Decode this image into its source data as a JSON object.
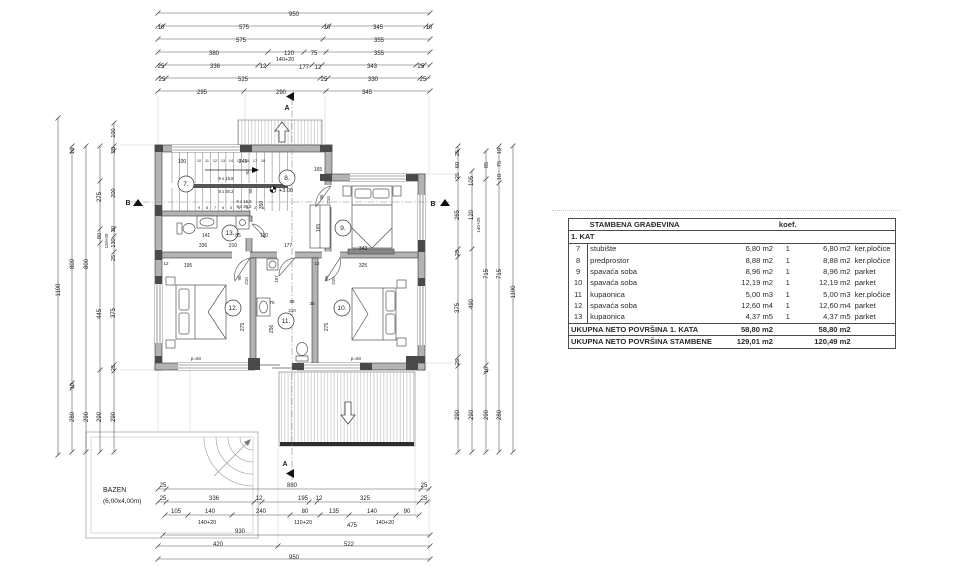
{
  "table": {
    "title": "STAMBENA GRAĐEVINA",
    "koef_label": "koef.",
    "section": "1. KAT",
    "rows": [
      {
        "num": "7",
        "name": "stubište",
        "area": "6,80 m2",
        "koef": "1",
        "area2": "6,80 m2",
        "floor": "ker.pločice"
      },
      {
        "num": "8",
        "name": "predprostor",
        "area": "8,88 m2",
        "koef": "1",
        "area2": "8,88 m2",
        "floor": "ker.pločice"
      },
      {
        "num": "9",
        "name": "spavaća soba",
        "area": "8,96 m2",
        "koef": "1",
        "area2": "8,96 m2",
        "floor": "parket"
      },
      {
        "num": "10",
        "name": "spavaća soba",
        "area": "12,19 m2",
        "koef": "1",
        "area2": "12,19 m2",
        "floor": "parket"
      },
      {
        "num": "11",
        "name": "kupaonica",
        "area": "5,00 m3",
        "koef": "1",
        "area2": "5,00 m3",
        "floor": "ker.pločice"
      },
      {
        "num": "12",
        "name": "spavaća soba",
        "area": "12,60 m4",
        "koef": "1",
        "area2": "12,60 m4",
        "floor": "parket"
      },
      {
        "num": "13",
        "name": "kupaonica",
        "area": "4,37 m5",
        "koef": "1",
        "area2": "4,37 m5",
        "floor": "parket"
      }
    ],
    "total1_label": "UKUPNA NETO POVRŠINA 1. KATA",
    "total1_a": "58,80 m2",
    "total1_b": "58,80 m2",
    "total2_label": "UKUPNA NETO POVRŠINA STAMBENE",
    "total2_a": "129,01 m2",
    "total2_b": "120,49 m2"
  },
  "pool": {
    "label1": "BAZEN",
    "label2": "(6,00x4,00m)"
  },
  "plan_texts": [
    {
      "t": "950",
      "x": 294,
      "y": 16
    },
    {
      "t": "10",
      "x": 161,
      "y": 29
    },
    {
      "t": "575",
      "x": 244,
      "y": 29
    },
    {
      "t": "10",
      "x": 327,
      "y": 29
    },
    {
      "t": "345",
      "x": 378,
      "y": 29
    },
    {
      "t": "10",
      "x": 429,
      "y": 29
    },
    {
      "t": "575",
      "x": 241,
      "y": 42
    },
    {
      "t": "355",
      "x": 379,
      "y": 42
    },
    {
      "t": "380",
      "x": 214,
      "y": 55
    },
    {
      "t": "120",
      "x": 289,
      "y": 55
    },
    {
      "t": "75",
      "x": 314,
      "y": 55
    },
    {
      "t": "355",
      "x": 379,
      "y": 55
    },
    {
      "t": "25",
      "x": 161,
      "y": 68
    },
    {
      "t": "336",
      "x": 215,
      "y": 68
    },
    {
      "t": "12",
      "x": 263,
      "y": 68
    },
    {
      "t": "140+20",
      "x": 285,
      "y": 61,
      "s": 5.5
    },
    {
      "t": "177",
      "x": 304,
      "y": 69
    },
    {
      "t": "12",
      "x": 318,
      "y": 69
    },
    {
      "t": "343",
      "x": 372,
      "y": 68
    },
    {
      "t": "25",
      "x": 421,
      "y": 68
    },
    {
      "t": "25",
      "x": 162,
      "y": 81
    },
    {
      "t": "525",
      "x": 243,
      "y": 81
    },
    {
      "t": "25",
      "x": 324,
      "y": 81
    },
    {
      "t": "330",
      "x": 373,
      "y": 81
    },
    {
      "t": "25",
      "x": 423,
      "y": 81
    },
    {
      "t": "295",
      "x": 202,
      "y": 94
    },
    {
      "t": "290",
      "x": 281,
      "y": 94
    },
    {
      "t": "345",
      "x": 367,
      "y": 94
    },
    {
      "t": "A",
      "x": 287,
      "y": 110,
      "s": 7,
      "b": 1
    },
    {
      "t": "25",
      "x": 163,
      "y": 487
    },
    {
      "t": "880",
      "x": 292,
      "y": 487
    },
    {
      "t": "25",
      "x": 424,
      "y": 487
    },
    {
      "t": "25",
      "x": 163,
      "y": 500
    },
    {
      "t": "336",
      "x": 214,
      "y": 500
    },
    {
      "t": "12",
      "x": 259,
      "y": 500
    },
    {
      "t": "195",
      "x": 303,
      "y": 500
    },
    {
      "t": "12",
      "x": 319,
      "y": 500
    },
    {
      "t": "325",
      "x": 365,
      "y": 500
    },
    {
      "t": "25",
      "x": 424,
      "y": 500
    },
    {
      "t": "105",
      "x": 176,
      "y": 513
    },
    {
      "t": "140",
      "x": 210,
      "y": 513
    },
    {
      "t": "240",
      "x": 261,
      "y": 513
    },
    {
      "t": "80",
      "x": 305,
      "y": 513
    },
    {
      "t": "135",
      "x": 334,
      "y": 513
    },
    {
      "t": "140",
      "x": 372,
      "y": 513
    },
    {
      "t": "90",
      "x": 407,
      "y": 513
    },
    {
      "t": "140+20",
      "x": 207,
      "y": 524,
      "s": 5.5
    },
    {
      "t": "110+20",
      "x": 303,
      "y": 524,
      "s": 5.5
    },
    {
      "t": "475",
      "x": 352,
      "y": 527
    },
    {
      "t": "140+20",
      "x": 385,
      "y": 524,
      "s": 5.5
    },
    {
      "t": "930",
      "x": 240,
      "y": 533
    },
    {
      "t": "420",
      "x": 218,
      "y": 546
    },
    {
      "t": "522",
      "x": 349,
      "y": 546
    },
    {
      "t": "950",
      "x": 294,
      "y": 559
    },
    {
      "t": "A",
      "x": 285,
      "y": 466,
      "s": 7,
      "b": 1
    },
    {
      "t": "1100",
      "x": 60,
      "y": 290,
      "r": 1
    },
    {
      "t": "10",
      "x": 74,
      "y": 151,
      "r": 1,
      "s": 5.5
    },
    {
      "t": "800",
      "x": 74,
      "y": 264,
      "r": 1
    },
    {
      "t": "10",
      "x": 74,
      "y": 386,
      "r": 1,
      "s": 5.5
    },
    {
      "t": "280",
      "x": 74,
      "y": 417,
      "r": 1
    },
    {
      "t": "800",
      "x": 88,
      "y": 264,
      "r": 1
    },
    {
      "t": "290",
      "x": 88,
      "y": 417,
      "r": 1
    },
    {
      "t": "275",
      "x": 101,
      "y": 197,
      "r": 1
    },
    {
      "t": "80",
      "x": 101,
      "y": 236,
      "r": 1,
      "s": 5.5
    },
    {
      "t": "445",
      "x": 101,
      "y": 314,
      "r": 1
    },
    {
      "t": "290",
      "x": 101,
      "y": 417,
      "r": 1
    },
    {
      "t": "110+20",
      "x": 108,
      "y": 241,
      "r": 1,
      "s": 4.5
    },
    {
      "t": "100",
      "x": 115,
      "y": 133,
      "r": 1,
      "s": 5.5
    },
    {
      "t": "25",
      "x": 115,
      "y": 150,
      "r": 1,
      "s": 5.5
    },
    {
      "t": "200",
      "x": 115,
      "y": 193,
      "r": 1,
      "s": 5.5
    },
    {
      "t": "20",
      "x": 115,
      "y": 229,
      "r": 1,
      "s": 5.5
    },
    {
      "t": "130",
      "x": 115,
      "y": 243,
      "r": 1,
      "s": 5.5
    },
    {
      "t": "25",
      "x": 115,
      "y": 258,
      "r": 1,
      "s": 5.5
    },
    {
      "t": "375",
      "x": 115,
      "y": 313,
      "r": 1
    },
    {
      "t": "25",
      "x": 115,
      "y": 368,
      "r": 1,
      "s": 5.5
    },
    {
      "t": "290",
      "x": 115,
      "y": 417,
      "r": 1
    },
    {
      "t": "B",
      "x": 128,
      "y": 205,
      "s": 7,
      "b": 1
    },
    {
      "t": "25",
      "x": 459,
      "y": 153,
      "r": 1,
      "s": 5.5
    },
    {
      "t": "60",
      "x": 459,
      "y": 165,
      "r": 1,
      "s": 5.5
    },
    {
      "t": "25",
      "x": 459,
      "y": 176,
      "r": 1,
      "s": 5.5
    },
    {
      "t": "265",
      "x": 459,
      "y": 215,
      "r": 1
    },
    {
      "t": "25",
      "x": 459,
      "y": 253,
      "r": 1,
      "s": 5.5
    },
    {
      "t": "375",
      "x": 459,
      "y": 308,
      "r": 1
    },
    {
      "t": "25",
      "x": 459,
      "y": 362,
      "r": 1,
      "s": 5.5
    },
    {
      "t": "290",
      "x": 459,
      "y": 415,
      "r": 1
    },
    {
      "t": "105",
      "x": 473,
      "y": 181,
      "r": 1
    },
    {
      "t": "120",
      "x": 473,
      "y": 215,
      "r": 1
    },
    {
      "t": "490",
      "x": 473,
      "y": 304,
      "r": 1
    },
    {
      "t": "290",
      "x": 473,
      "y": 415,
      "r": 1
    },
    {
      "t": "140+20",
      "x": 480,
      "y": 225,
      "r": 1,
      "s": 4.5
    },
    {
      "t": "85",
      "x": 488,
      "y": 165,
      "r": 1,
      "s": 5.5
    },
    {
      "t": "715",
      "x": 488,
      "y": 274,
      "r": 1
    },
    {
      "t": "10",
      "x": 488,
      "y": 370,
      "r": 1,
      "s": 5.5
    },
    {
      "t": "290",
      "x": 488,
      "y": 415,
      "r": 1
    },
    {
      "t": "10",
      "x": 501,
      "y": 151,
      "r": 1,
      "s": 5.5
    },
    {
      "t": "75",
      "x": 501,
      "y": 164,
      "r": 1,
      "s": 5.5
    },
    {
      "t": "10",
      "x": 501,
      "y": 177,
      "r": 1,
      "s": 5.5
    },
    {
      "t": "715",
      "x": 501,
      "y": 274,
      "r": 1
    },
    {
      "t": "280",
      "x": 501,
      "y": 415,
      "r": 1
    },
    {
      "t": "1100",
      "x": 515,
      "y": 292,
      "r": 1
    },
    {
      "t": "B",
      "x": 433,
      "y": 206,
      "s": 7,
      "b": 1
    },
    {
      "t": "100",
      "x": 182,
      "y": 163,
      "s": 5
    },
    {
      "t": "245",
      "x": 243,
      "y": 163,
      "s": 5
    },
    {
      "t": "92",
      "x": 249,
      "y": 172,
      "r": 1,
      "s": 4.5
    },
    {
      "t": "9 x 16,8",
      "x": 226,
      "y": 180,
      "s": 4.2
    },
    {
      "t": "8 x 30,2",
      "x": 226,
      "y": 193,
      "s": 4.2
    },
    {
      "t": "9 x 16,8",
      "x": 244,
      "y": 203,
      "s": 4.2
    },
    {
      "t": "8 x 30,2",
      "x": 244,
      "y": 208,
      "s": 4.2
    },
    {
      "t": "10",
      "x": 199,
      "y": 162,
      "s": 3.8
    },
    {
      "t": "11",
      "x": 207,
      "y": 162,
      "s": 3.8
    },
    {
      "t": "12",
      "x": 215,
      "y": 162,
      "s": 3.8
    },
    {
      "t": "13",
      "x": 223,
      "y": 162,
      "s": 3.8
    },
    {
      "t": "14",
      "x": 231,
      "y": 162,
      "s": 3.8
    },
    {
      "t": "15",
      "x": 239,
      "y": 162,
      "s": 3.8
    },
    {
      "t": "16",
      "x": 247,
      "y": 162,
      "s": 3.8
    },
    {
      "t": "17",
      "x": 255,
      "y": 162,
      "s": 3.8
    },
    {
      "t": "18",
      "x": 263,
      "y": 162,
      "s": 3.8
    },
    {
      "t": "9",
      "x": 199,
      "y": 209,
      "s": 3.8
    },
    {
      "t": "8",
      "x": 207,
      "y": 209,
      "s": 3.8
    },
    {
      "t": "7",
      "x": 215,
      "y": 209,
      "s": 3.8
    },
    {
      "t": "6",
      "x": 223,
      "y": 209,
      "s": 3.8
    },
    {
      "t": "5",
      "x": 231,
      "y": 209,
      "s": 3.8
    },
    {
      "t": "4",
      "x": 239,
      "y": 209,
      "s": 3.8
    },
    {
      "t": "3",
      "x": 247,
      "y": 209,
      "s": 3.8
    },
    {
      "t": "2",
      "x": 255,
      "y": 209,
      "s": 3.8
    },
    {
      "t": "1",
      "x": 263,
      "y": 209,
      "s": 3.8
    },
    {
      "t": "165",
      "x": 318,
      "y": 171,
      "s": 5
    },
    {
      "t": "+3.00",
      "x": 286,
      "y": 192,
      "s": 5.5
    },
    {
      "t": "95",
      "x": 252,
      "y": 191,
      "r": 1,
      "s": 4.5
    },
    {
      "t": "350",
      "x": 263,
      "y": 205,
      "r": 1,
      "s": 5
    },
    {
      "t": "141",
      "x": 206,
      "y": 237,
      "s": 5
    },
    {
      "t": "85",
      "x": 238,
      "y": 237,
      "s": 5
    },
    {
      "t": "110",
      "x": 264,
      "y": 237,
      "s": 5
    },
    {
      "t": "336",
      "x": 203,
      "y": 247,
      "s": 5
    },
    {
      "t": "210",
      "x": 233,
      "y": 247,
      "s": 5
    },
    {
      "t": "177",
      "x": 288,
      "y": 247,
      "s": 5
    },
    {
      "t": "12",
      "x": 166,
      "y": 265,
      "s": 4.5
    },
    {
      "t": "195",
      "x": 188,
      "y": 267,
      "s": 5
    },
    {
      "t": "12",
      "x": 317,
      "y": 265,
      "s": 4.5
    },
    {
      "t": "325",
      "x": 363,
      "y": 267,
      "s": 5
    },
    {
      "t": "107",
      "x": 278,
      "y": 279,
      "r": 1,
      "s": 4.5
    },
    {
      "t": "95",
      "x": 323,
      "y": 197,
      "r": 1,
      "s": 4.5
    },
    {
      "t": "210",
      "x": 330,
      "y": 200,
      "r": 1,
      "s": 4.5
    },
    {
      "t": "165",
      "x": 320,
      "y": 228,
      "r": 1,
      "s": 5
    },
    {
      "t": "343",
      "x": 363,
      "y": 250,
      "s": 5
    },
    {
      "t": "95",
      "x": 241,
      "y": 278,
      "r": 1,
      "s": 4.5
    },
    {
      "t": "210",
      "x": 248,
      "y": 281,
      "r": 1,
      "s": 4.5
    },
    {
      "t": "275",
      "x": 244,
      "y": 327,
      "r": 1,
      "s": 5
    },
    {
      "t": "p=60",
      "x": 196,
      "y": 360,
      "s": 4.5
    },
    {
      "t": "75",
      "x": 272,
      "y": 304,
      "s": 4.5
    },
    {
      "t": "85",
      "x": 292,
      "y": 303,
      "s": 4.5
    },
    {
      "t": "210",
      "x": 292,
      "y": 312,
      "s": 4.5
    },
    {
      "t": "256",
      "x": 273,
      "y": 329,
      "r": 1,
      "s": 5
    },
    {
      "t": "95",
      "x": 328,
      "y": 278,
      "r": 1,
      "s": 4.5
    },
    {
      "t": "210",
      "x": 335,
      "y": 281,
      "r": 1,
      "s": 4.5
    },
    {
      "t": "275",
      "x": 328,
      "y": 327,
      "r": 1,
      "s": 5
    },
    {
      "t": "35",
      "x": 312,
      "y": 305,
      "s": 4.5
    },
    {
      "t": "p=60",
      "x": 356,
      "y": 360,
      "s": 4.5
    },
    {
      "t": "7.",
      "x": 186,
      "y": 186,
      "s": 6.5
    },
    {
      "t": "8.",
      "x": 287,
      "y": 180,
      "s": 6.5
    },
    {
      "t": "9.",
      "x": 343,
      "y": 230,
      "s": 6.5
    },
    {
      "t": "10.",
      "x": 342,
      "y": 310,
      "s": 6.5
    },
    {
      "t": "11.",
      "x": 286,
      "y": 323,
      "s": 6.5
    },
    {
      "t": "12.",
      "x": 233,
      "y": 310,
      "s": 6.5
    },
    {
      "t": "13.",
      "x": 230,
      "y": 235,
      "s": 6.5
    },
    {
      "t": "BAZEN",
      "x": 103,
      "y": 492,
      "s": 7,
      "a": "start"
    },
    {
      "t": "(6,00x4,00m)",
      "x": 103,
      "y": 503,
      "s": 6.5,
      "a": "start"
    }
  ]
}
